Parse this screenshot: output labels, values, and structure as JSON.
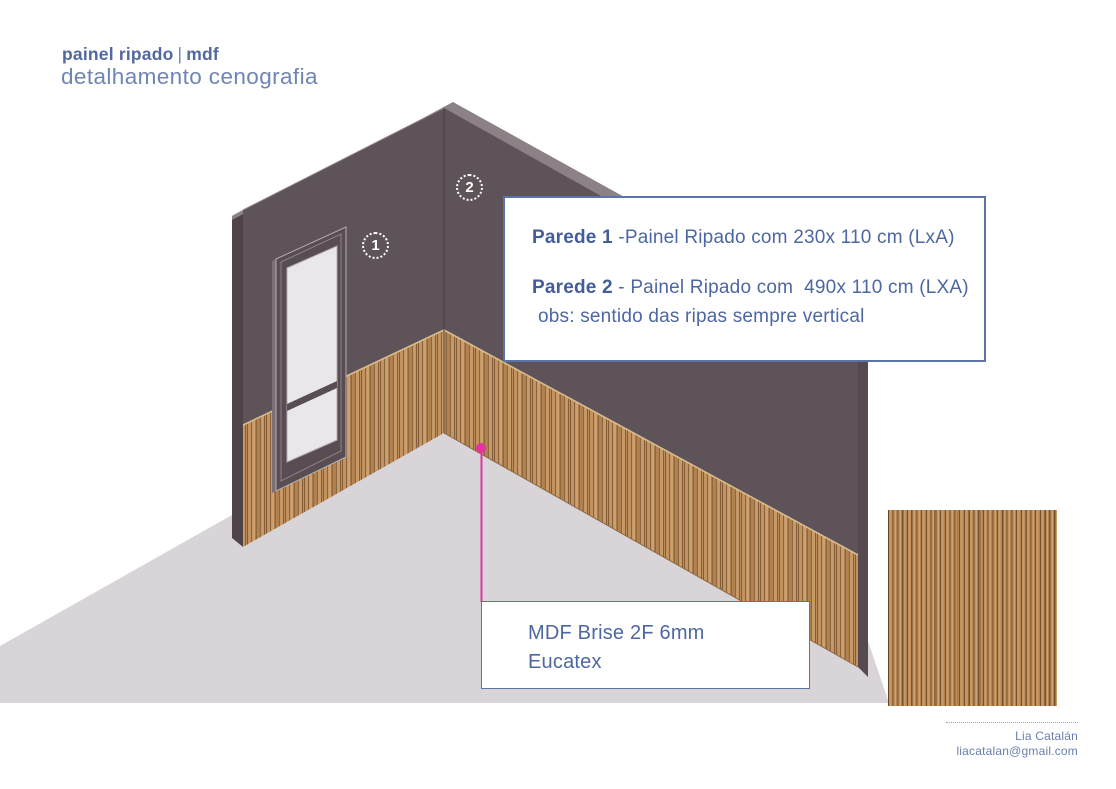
{
  "header": {
    "title_bold": "painel ripado",
    "title_sep": "|",
    "title_bold2": "mdf",
    "subtitle": "detalhamento cenografia"
  },
  "markers": {
    "wall1_label": "1",
    "wall2_label": "2"
  },
  "spec_box": {
    "line1_label": "Parede 1",
    "line1_text": " -Painel Ripado com 230x 110 cm (LxA)",
    "line2_label": "Parede 2",
    "line2_text": " - Painel Ripado com  490x 110 cm (LXA)",
    "note": "obs: sentido das ripas sempre vertical"
  },
  "material_box": {
    "line1": "MDF Brise 2F 6mm",
    "line2": "Eucatex"
  },
  "credits": {
    "name": "Lia Catalán",
    "email": "liacatalan@gmail.com"
  },
  "colors": {
    "accent_blue": "#5b74a6",
    "text_blue": "#4d67a1",
    "wall_face": "#5e5358",
    "wall_side": "#4d4348",
    "wall_cap": "#8c8186",
    "wood_base": "#bc8d5a",
    "floor": "#d8d4d7",
    "leader_pink": "#e433a0",
    "glass": "#e9e7ea"
  }
}
